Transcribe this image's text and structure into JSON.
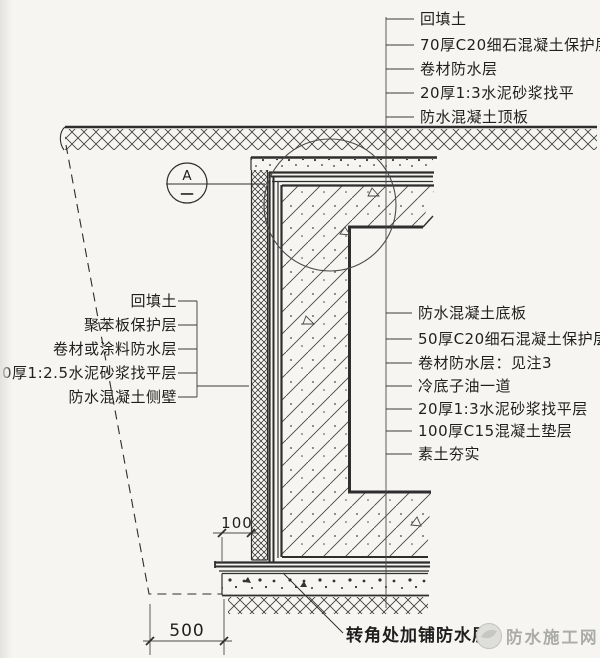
{
  "drawing": {
    "labels_top": [
      "回填土",
      "70厚C20细石混凝土保护层",
      "卷材防水层",
      "20厚1:3水泥砂浆找平",
      "防水混凝土顶板"
    ],
    "labels_left": [
      "回填土",
      "聚苯板保护层",
      "卷材或涂料防水层",
      "20厚1:2.5水泥砂浆找平层",
      "防水混凝土侧壁"
    ],
    "labels_right": [
      "防水混凝土底板",
      "50厚C20细石混凝土保护层",
      "卷材防水层：见注3",
      "冷底子油一道",
      "20厚1:3水泥砂浆找平层",
      "100厚C15混凝土垫层",
      "素土夯实"
    ],
    "label_corner": "转角处加铺防水层",
    "detail_mark": {
      "letter": "A",
      "number": "一"
    },
    "dimensions": {
      "offset": "100",
      "working_space": "500"
    },
    "watermark": "防水施工网",
    "colors": {
      "paper": "#f6f5f1",
      "line": "#2e2e2e",
      "text": "#1f1f1f",
      "watermark": "#ababa8"
    }
  }
}
